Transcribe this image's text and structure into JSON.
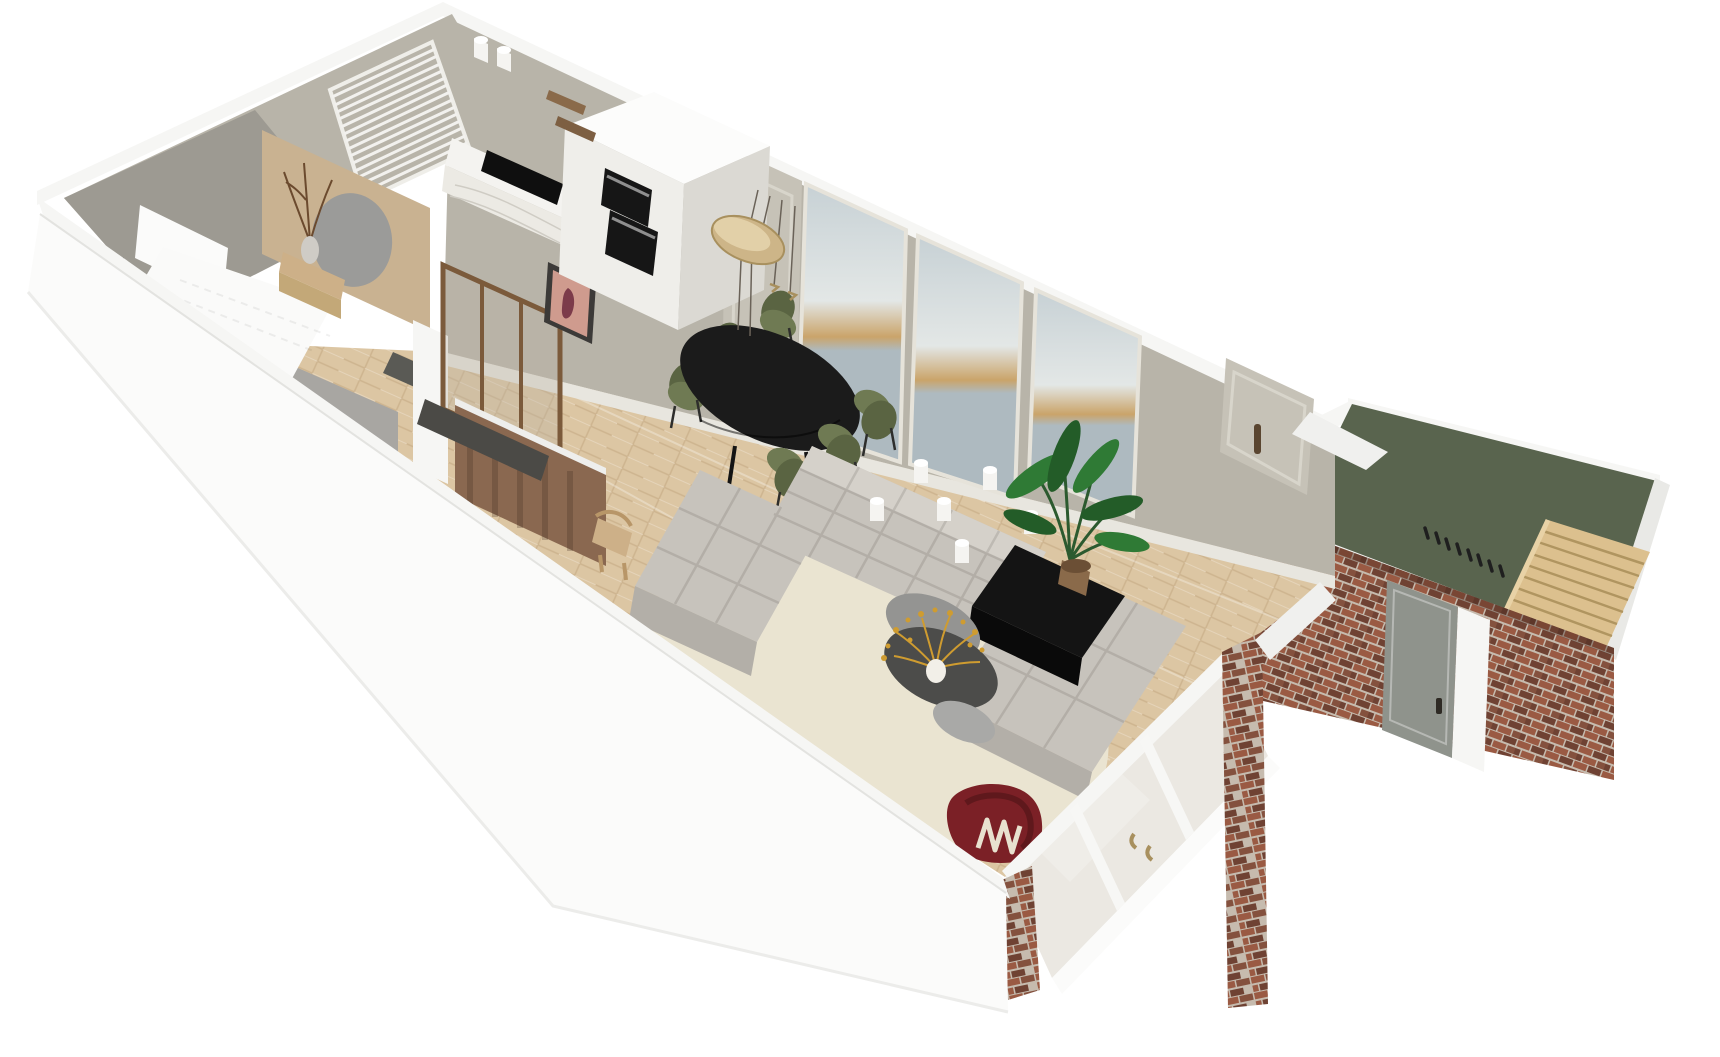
{
  "meta": {
    "app": "floorplan-3d-render",
    "description": "3D bird's-eye render of an elongated apartment: hallway and bedroom left, kitchen and dining centre, living room with modular sofa right, sea-view window wall, and a brick annex with green roof terrace and wooden stair far right",
    "background": "#ffffff"
  },
  "palette": {
    "white_wall": "#f6f6f4",
    "wall_shade": "#e9e9e6",
    "greige": "#b8b4a9",
    "greige_light": "#c6c2b7",
    "gray_wall": "#9d9a92",
    "floor": "#dcc6a3",
    "rug": "#eae4d1",
    "sofa": "#c7c3bc",
    "sofa_dark": "#b3afa8",
    "sofa_light": "#d5d1ca",
    "table_black": "#1b1b1b",
    "chair_green": "#6f7a53",
    "chair_green_dark": "#5a6442",
    "brass": "#cdb588",
    "brass_dark": "#a8905e",
    "candle": "#f5f4f1",
    "sideboard": "#141414",
    "plant": "#2f7a35",
    "plant_dark": "#235c28",
    "pot": "#8a6a4a",
    "coffee_dark": "#4c4c4a",
    "coffee_gray": "#949492",
    "flower_gold": "#cf9c30",
    "red_chair": "#7b2026",
    "cream_rack": "#e8e1cf",
    "brick": "#9a5a43",
    "brick_dark": "#6f4233",
    "mortar": "#c6bbae",
    "terrace_green": "#59644e",
    "stairs_wood": "#dcc08e",
    "stairs_line": "#b09560",
    "tan_wall": "#c9b291",
    "mirror": "#9b9b99",
    "bronze": "#7b5a3b",
    "brown_wall": "#8a6850",
    "bench_dark": "#4b4a46",
    "glass": "#d8d2c6",
    "sea_top": "#c7d1d5",
    "sea_mid": "#e3e7e6",
    "sea_low": "#aebac0",
    "horizon_gold": "#caa46a",
    "door_gray": "#8f938c",
    "oven": "#161616",
    "marble": "#eceae4",
    "cooktop": "#0f0f0f",
    "oak": "#cdb088",
    "poster_bg": "#cf9b8e",
    "poster_fig": "#7c3b4a",
    "frame_dark": "#3c3a38",
    "blind_slat": "#f2f1ee",
    "branch": "#6b4a2e"
  },
  "scene": {
    "rooms": [
      {
        "name": "hallway"
      },
      {
        "name": "bedroom"
      },
      {
        "name": "kitchen"
      },
      {
        "name": "dining-area"
      },
      {
        "name": "living-room"
      },
      {
        "name": "roof-terrace-annex"
      }
    ],
    "architecture": [
      {
        "name": "window-wall-sea-view",
        "windows": 3,
        "color_ref": "greige"
      },
      {
        "name": "venetian-blind-window",
        "color_ref": "blind_slat"
      },
      {
        "name": "sliding-glass-doors",
        "color_ref": "glass"
      },
      {
        "name": "brick-annex-wall",
        "color_ref": "brick"
      },
      {
        "name": "green-roof-terrace",
        "color_ref": "terrace_green"
      },
      {
        "name": "wooden-stair",
        "color_ref": "stairs_wood"
      },
      {
        "name": "bronze-glass-door",
        "color_ref": "bronze"
      },
      {
        "name": "herringbone-wood-floor",
        "color_ref": "floor"
      }
    ],
    "furniture": [
      {
        "name": "modular-sofa",
        "color_ref": "sofa"
      },
      {
        "name": "oval-dining-table",
        "color_ref": "table_black"
      },
      {
        "name": "dining-chairs",
        "count": 6,
        "color_ref": "chair_green"
      },
      {
        "name": "brass-disc-pendant",
        "color_ref": "brass"
      },
      {
        "name": "double-oven-column",
        "color_ref": "oven"
      },
      {
        "name": "induction-cooktop",
        "color_ref": "cooktop"
      },
      {
        "name": "pillar-candles",
        "count": 6,
        "color_ref": "candle"
      },
      {
        "name": "black-sideboard",
        "color_ref": "sideboard"
      },
      {
        "name": "banana-plant",
        "color_ref": "plant"
      },
      {
        "name": "oval-coffee-table-set",
        "color_ref": "coffee_dark"
      },
      {
        "name": "gold-bouquet",
        "color_ref": "flower_gold"
      },
      {
        "name": "burgundy-armchair",
        "color_ref": "red_chair"
      },
      {
        "name": "magazine-rack",
        "color_ref": "cream_rack"
      },
      {
        "name": "round-mirror",
        "color_ref": "mirror"
      },
      {
        "name": "console-table",
        "color_ref": "oak"
      },
      {
        "name": "branch-vase",
        "color_ref": "branch"
      },
      {
        "name": "cream-rug",
        "color_ref": "rug"
      },
      {
        "name": "art-poster",
        "color_ref": "poster_bg"
      }
    ]
  }
}
